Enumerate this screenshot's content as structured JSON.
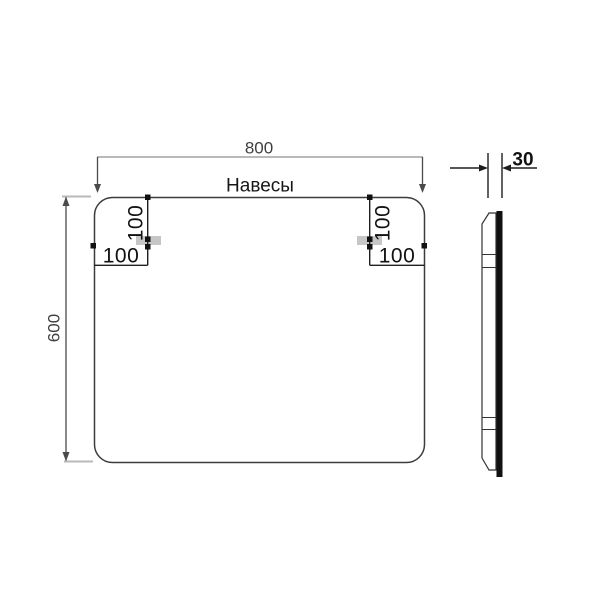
{
  "title": "Навесы",
  "front_view": {
    "width_label": "800",
    "height_label": "600",
    "width_value": 800,
    "height_value": 600,
    "hanger_left": {
      "offset_top_label": "100",
      "offset_side_label": "100"
    },
    "hanger_right": {
      "offset_top_label": "100",
      "offset_side_label": "100"
    }
  },
  "side_view": {
    "thickness_label": "30",
    "thickness_value": 30
  },
  "colors": {
    "outline": "#3c3c3c",
    "dim_gray": "#b9b9b9",
    "dim_dark": "#4a4a4a",
    "dim_black": "#1f1f1f",
    "hanger_fill": "#c6c6c6",
    "glass": "#111111",
    "text_dark": "#161616",
    "text_dim": "#3f3f3f"
  }
}
